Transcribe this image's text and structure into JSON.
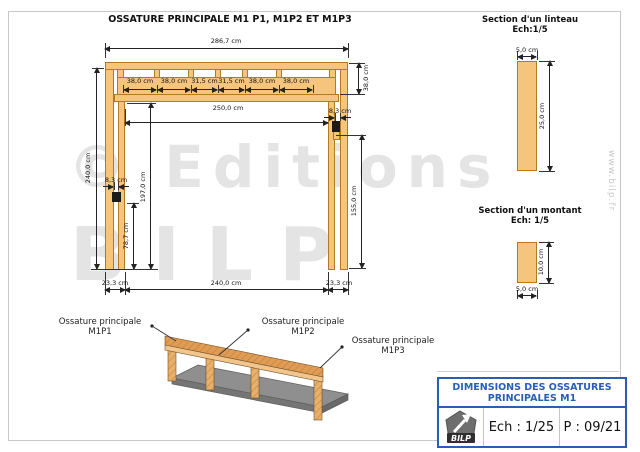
{
  "page": {
    "main_title": "OSSATURE PRINCIPALE M1 P1, M1P2 ET M1P3",
    "watermark_text": "© Editions",
    "watermark_text2": "BILP",
    "watermark_url": "www.bilp.fr"
  },
  "main_drawing": {
    "dim_overall_width": "286,7 cm",
    "dim_segments": [
      "38,0 cm",
      "38,0 cm",
      "31,5 cm",
      "31,5 cm",
      "38,0 cm",
      "38,0 cm"
    ],
    "dim_header_height": "38,0 cm",
    "dim_opening_width": "250,0 cm",
    "dim_gap_right": "8,3 cm",
    "dim_gap_left": "8,3 cm",
    "dim_total_height": "240,0 cm",
    "dim_inner_height": "197,0 cm",
    "dim_right_stud": "155,0 cm",
    "dim_left_stud": "78,7 cm",
    "dim_bottom_left": "23,3 cm",
    "dim_bottom_center": "240,0 cm",
    "dim_bottom_right": "23,3 cm"
  },
  "linteau_section": {
    "title": "Section d'un linteau",
    "scale": "Ech:1/5",
    "dim_width": "5,0 cm",
    "dim_height": "25,0 cm"
  },
  "montant_section": {
    "title": "Section d'un montant",
    "scale": "Ech: 1/5",
    "dim_height": "10,0 cm",
    "dim_width": "5,0 cm"
  },
  "iso_view": {
    "labels": [
      {
        "line1": "Ossature principale",
        "line2": "M1P1"
      },
      {
        "line1": "Ossature principale",
        "line2": "M1P2"
      },
      {
        "line1": "Ossature principale",
        "line2": "M1P3"
      }
    ]
  },
  "title_block": {
    "title_line1": "DIMENSIONS DES OSSATURES",
    "title_line2": "PRINCIPALES M1",
    "logo_text": "BILP",
    "scale_value": "Ech : 1/25",
    "page_value": "P : 09/21"
  },
  "colors": {
    "wood": "#f5c57e",
    "wood_border": "#b5791f",
    "accent_blue": "#2a5db4",
    "slab_gray": "#8f8f8f",
    "watermark": "#e4e4e4"
  }
}
